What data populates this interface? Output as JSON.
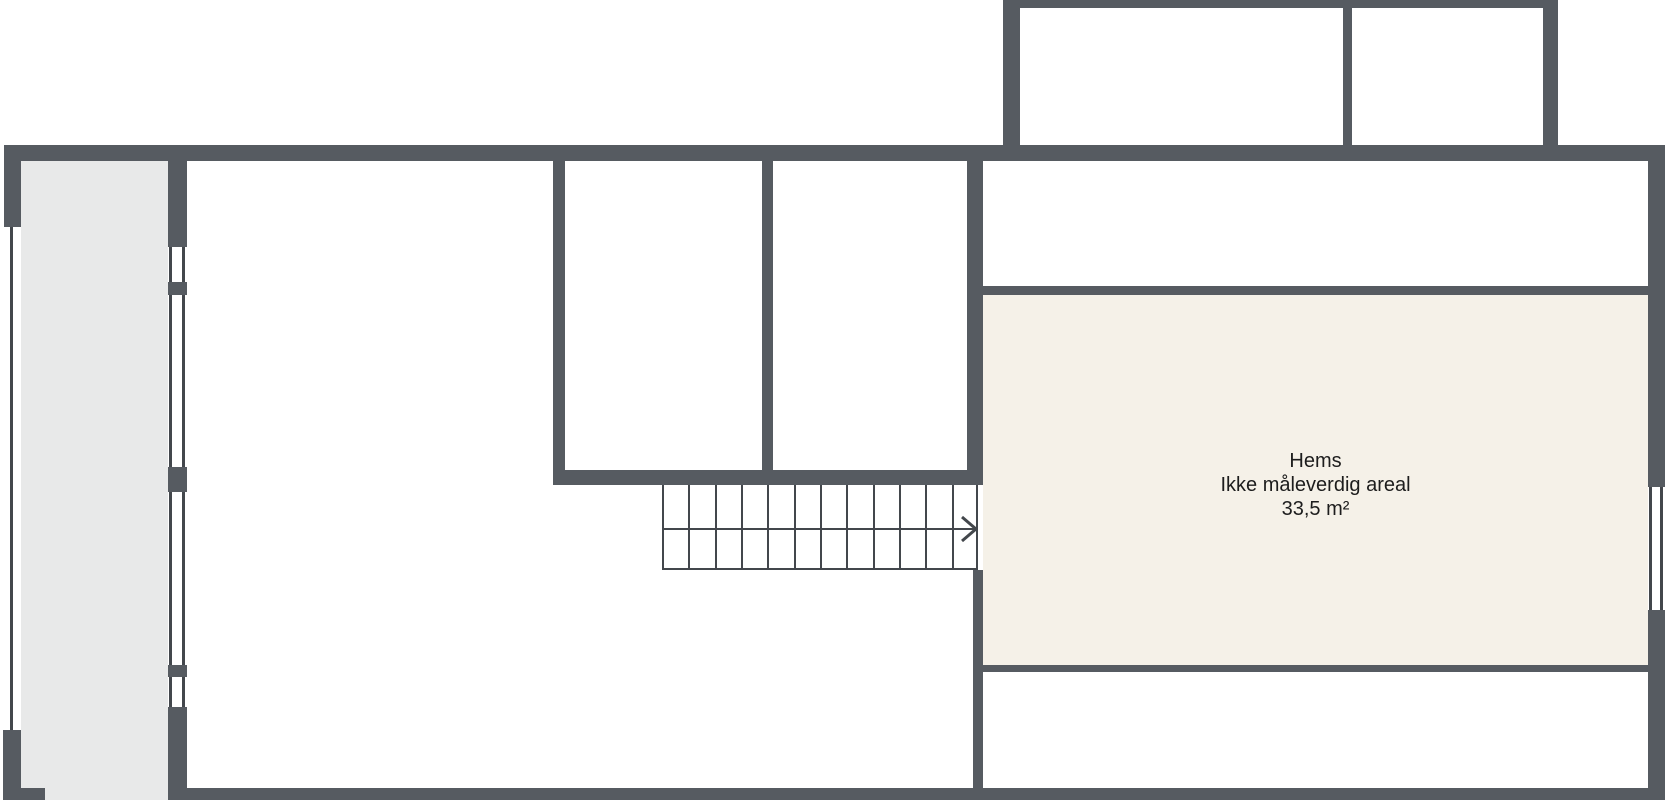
{
  "floorplan": {
    "room_label": {
      "name": "Hems",
      "note": "Ikke måleverdig areal",
      "area": "33,5 m²"
    },
    "stairs": {
      "step_count": 12,
      "direction": "right"
    },
    "colors": {
      "wall": "#565b61",
      "line": "#43474c",
      "balcony_floor": "#e8e9e9",
      "hems_floor": "#f5f1e8",
      "room_floor": "#ffffff",
      "background": "#ffffff",
      "text": "#1d1d1d"
    }
  }
}
